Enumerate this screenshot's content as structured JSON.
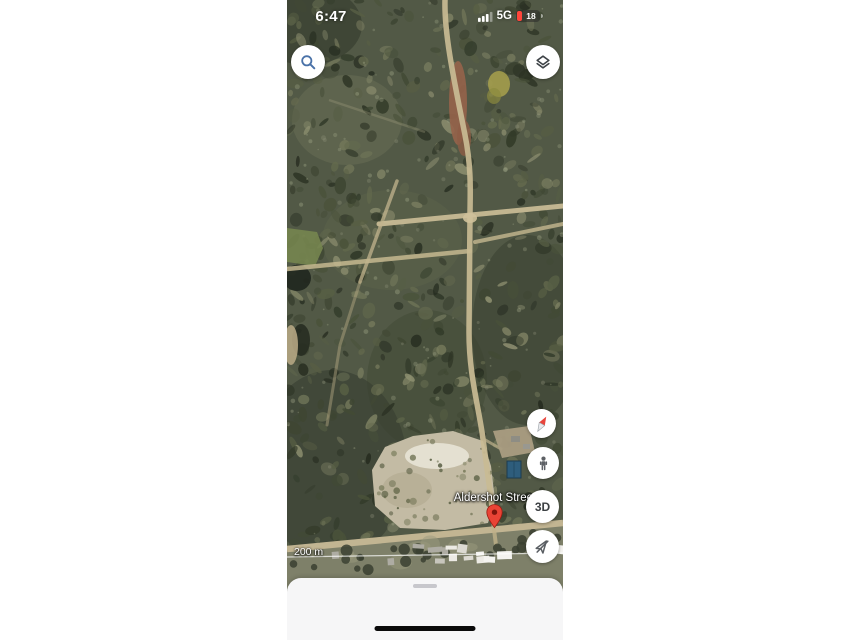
{
  "status_bar": {
    "time": "6:47",
    "signal_icon": "cellular-signal-bars",
    "network": "5G",
    "battery_icon": "battery-low-with-percent",
    "battery_level": "18"
  },
  "map_ui": {
    "search_icon": "magnifying-glass",
    "layers_icon": "map-layers-diamond-stack",
    "compass_icon": "compass-needle",
    "streetview_icon": "pegman-person",
    "threed_button_label": "3D",
    "location_icon": "location-arrow-disabled",
    "marker_icon": "red-map-pin",
    "place_label": "Aldershot Street",
    "scale_label": "200 m"
  },
  "bottom_sheet": {
    "drag_handle_icon": "drag-handle-pill",
    "home_indicator_icon": "ios-home-indicator"
  },
  "colors": {
    "pin_red": "#e94335",
    "battery_red": "#ff453a",
    "search_blue": "#4a72a8",
    "icon_gray": "#3e4347",
    "sheet_bg": "#f6f6f7",
    "forest_base": "#525946",
    "track_beige": "#c9bb94",
    "red_dirt": "#96634a"
  }
}
